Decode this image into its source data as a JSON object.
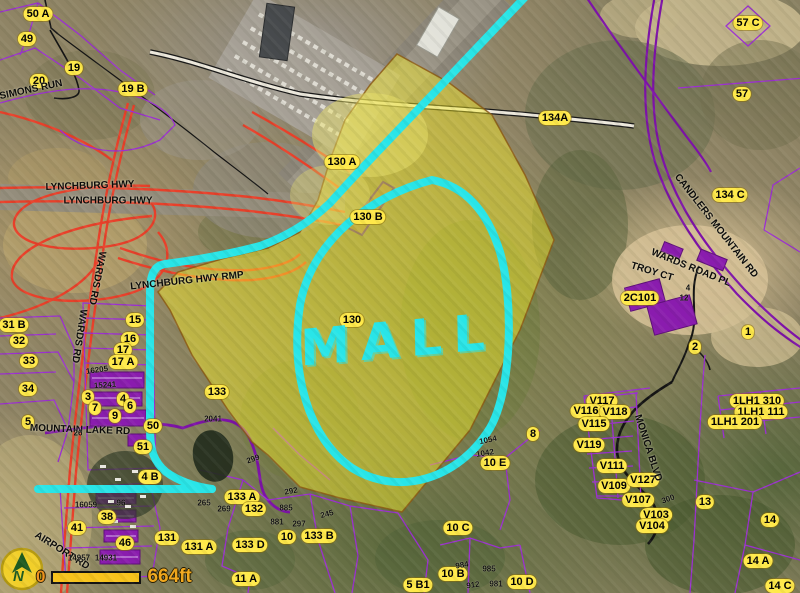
{
  "annotations": {
    "mall_text": "MALL",
    "cyan": "#29e5e8"
  },
  "scalebar": {
    "zero_label": "0",
    "distance_label": "664ft"
  },
  "north_arrow": {
    "letter": "N"
  },
  "colors": {
    "parcel_label_bg": "#ffe94a",
    "parcel_line_purple": "#9b30d0",
    "road_purple": "#7d12a8",
    "highway_red": "#e8402a",
    "highlight_yellow": "rgba(250,240,40,0.45)",
    "annotation_cyan": "#29e5e8"
  },
  "parcel_labels": [
    {
      "text": "50 A",
      "x": 38,
      "y": 14
    },
    {
      "text": "49",
      "x": 27,
      "y": 39
    },
    {
      "text": "19",
      "x": 74,
      "y": 68
    },
    {
      "text": "20",
      "x": 39,
      "y": 81
    },
    {
      "text": "19 B",
      "x": 133,
      "y": 89
    },
    {
      "text": "57 C",
      "x": 748,
      "y": 23
    },
    {
      "text": "57",
      "x": 742,
      "y": 94
    },
    {
      "text": "134A",
      "x": 555,
      "y": 118
    },
    {
      "text": "130 A",
      "x": 342,
      "y": 162
    },
    {
      "text": "130 B",
      "x": 368,
      "y": 217
    },
    {
      "text": "134 C",
      "x": 730,
      "y": 195
    },
    {
      "text": "2C101",
      "x": 640,
      "y": 298
    },
    {
      "text": "1",
      "x": 748,
      "y": 332
    },
    {
      "text": "2",
      "x": 695,
      "y": 347
    },
    {
      "text": "31 B",
      "x": 14,
      "y": 325
    },
    {
      "text": "32",
      "x": 19,
      "y": 341
    },
    {
      "text": "33",
      "x": 29,
      "y": 361
    },
    {
      "text": "34",
      "x": 28,
      "y": 389
    },
    {
      "text": "5",
      "x": 28,
      "y": 422
    },
    {
      "text": "15",
      "x": 135,
      "y": 320
    },
    {
      "text": "16",
      "x": 130,
      "y": 339
    },
    {
      "text": "17",
      "x": 123,
      "y": 350
    },
    {
      "text": "17 A",
      "x": 123,
      "y": 362
    },
    {
      "text": "3",
      "x": 88,
      "y": 397
    },
    {
      "text": "4",
      "x": 123,
      "y": 399
    },
    {
      "text": "6",
      "x": 130,
      "y": 406
    },
    {
      "text": "7",
      "x": 95,
      "y": 408
    },
    {
      "text": "9",
      "x": 115,
      "y": 416
    },
    {
      "text": "50",
      "x": 153,
      "y": 426
    },
    {
      "text": "51",
      "x": 143,
      "y": 447
    },
    {
      "text": "4 B",
      "x": 150,
      "y": 477
    },
    {
      "text": "38",
      "x": 107,
      "y": 517
    },
    {
      "text": "41",
      "x": 77,
      "y": 528
    },
    {
      "text": "46",
      "x": 125,
      "y": 543
    },
    {
      "text": "131",
      "x": 167,
      "y": 538
    },
    {
      "text": "131 A",
      "x": 199,
      "y": 547
    },
    {
      "text": "133",
      "x": 217,
      "y": 392
    },
    {
      "text": "133 A",
      "x": 242,
      "y": 497
    },
    {
      "text": "132",
      "x": 254,
      "y": 509
    },
    {
      "text": "133 D",
      "x": 250,
      "y": 545
    },
    {
      "text": "10",
      "x": 287,
      "y": 537
    },
    {
      "text": "133 B",
      "x": 319,
      "y": 536
    },
    {
      "text": "11 A",
      "x": 246,
      "y": 579
    },
    {
      "text": "5 B1",
      "x": 418,
      "y": 585
    },
    {
      "text": "10 B",
      "x": 453,
      "y": 574
    },
    {
      "text": "10 D",
      "x": 522,
      "y": 582
    },
    {
      "text": "10 C",
      "x": 458,
      "y": 528
    },
    {
      "text": "10 E",
      "x": 495,
      "y": 463
    },
    {
      "text": "8",
      "x": 533,
      "y": 434
    },
    {
      "text": "130",
      "x": 352,
      "y": 320
    },
    {
      "text": "13",
      "x": 705,
      "y": 502
    },
    {
      "text": "14",
      "x": 770,
      "y": 520
    },
    {
      "text": "14 A",
      "x": 758,
      "y": 561
    },
    {
      "text": "14 C",
      "x": 780,
      "y": 586
    },
    {
      "text": "V117",
      "x": 602,
      "y": 401
    },
    {
      "text": "V116",
      "x": 586,
      "y": 411
    },
    {
      "text": "V118",
      "x": 615,
      "y": 412
    },
    {
      "text": "V115",
      "x": 594,
      "y": 424
    },
    {
      "text": "V119",
      "x": 589,
      "y": 445
    },
    {
      "text": "V111",
      "x": 612,
      "y": 466
    },
    {
      "text": "V109",
      "x": 614,
      "y": 486
    },
    {
      "text": "V127",
      "x": 643,
      "y": 480
    },
    {
      "text": "V107",
      "x": 638,
      "y": 500
    },
    {
      "text": "V103",
      "x": 656,
      "y": 515
    },
    {
      "text": "V104",
      "x": 652,
      "y": 526
    },
    {
      "text": "1LH1 310",
      "x": 757,
      "y": 401
    },
    {
      "text": "1LH1 111",
      "x": 761,
      "y": 412
    },
    {
      "text": "1LH1 201",
      "x": 735,
      "y": 422
    }
  ],
  "road_labels": [
    {
      "text": "SIMONS RUN",
      "x": 31,
      "y": 90,
      "rot": -12
    },
    {
      "text": "LYNCHBURG HWY",
      "x": 90,
      "y": 186,
      "rot": -2
    },
    {
      "text": "LYNCHBURG HWY",
      "x": 108,
      "y": 201,
      "rot": 0
    },
    {
      "text": "WARDS RD",
      "x": 97,
      "y": 278,
      "rot": 101
    },
    {
      "text": "WARDS RD",
      "x": 79,
      "y": 336,
      "rot": 99
    },
    {
      "text": "LYNCHBURG HWY RMP",
      "x": 187,
      "y": 281,
      "rot": -6
    },
    {
      "text": "CANDLERS MOUNTAIN RD",
      "x": 716,
      "y": 226,
      "rot": 52
    },
    {
      "text": "WARDS ROAD PL",
      "x": 691,
      "y": 268,
      "rot": 22
    },
    {
      "text": "TROY CT",
      "x": 652,
      "y": 272,
      "rot": 17
    },
    {
      "text": "MONICA BLVD",
      "x": 648,
      "y": 448,
      "rot": 72
    },
    {
      "text": "MOUNTAIN LAKE RD",
      "x": 80,
      "y": 430,
      "rot": 2
    },
    {
      "text": "AIRPORT RD",
      "x": 62,
      "y": 551,
      "rot": 32
    }
  ],
  "address_labels": [
    {
      "text": "16205",
      "x": 97,
      "y": 370,
      "rot": -8
    },
    {
      "text": "15241",
      "x": 105,
      "y": 385,
      "rot": -4
    },
    {
      "text": "2041",
      "x": 213,
      "y": 419,
      "rot": 0
    },
    {
      "text": "26",
      "x": 78,
      "y": 433,
      "rot": 0
    },
    {
      "text": "16059",
      "x": 86,
      "y": 505,
      "rot": 0
    },
    {
      "text": "96",
      "x": 121,
      "y": 503,
      "rot": 0
    },
    {
      "text": "14957",
      "x": 79,
      "y": 558,
      "rot": 0
    },
    {
      "text": "14931",
      "x": 106,
      "y": 558,
      "rot": 0
    },
    {
      "text": "299",
      "x": 253,
      "y": 459,
      "rot": -20
    },
    {
      "text": "292",
      "x": 291,
      "y": 491,
      "rot": -10
    },
    {
      "text": "265",
      "x": 204,
      "y": 503,
      "rot": 0
    },
    {
      "text": "269",
      "x": 224,
      "y": 509,
      "rot": 0
    },
    {
      "text": "885",
      "x": 286,
      "y": 508,
      "rot": 0
    },
    {
      "text": "881",
      "x": 277,
      "y": 522,
      "rot": 0
    },
    {
      "text": "297",
      "x": 299,
      "y": 524,
      "rot": 0
    },
    {
      "text": "245",
      "x": 327,
      "y": 514,
      "rot": -15
    },
    {
      "text": "984",
      "x": 462,
      "y": 565,
      "rot": -10
    },
    {
      "text": "985",
      "x": 489,
      "y": 569,
      "rot": 0
    },
    {
      "text": "912",
      "x": 473,
      "y": 585,
      "rot": -8
    },
    {
      "text": "981",
      "x": 496,
      "y": 584,
      "rot": 0
    },
    {
      "text": "1054",
      "x": 488,
      "y": 440,
      "rot": -12
    },
    {
      "text": "1042",
      "x": 485,
      "y": 453,
      "rot": -10
    },
    {
      "text": "300",
      "x": 668,
      "y": 499,
      "rot": -20
    },
    {
      "text": "4",
      "x": 688,
      "y": 288,
      "rot": 0
    },
    {
      "text": "12",
      "x": 684,
      "y": 298,
      "rot": 0
    }
  ]
}
